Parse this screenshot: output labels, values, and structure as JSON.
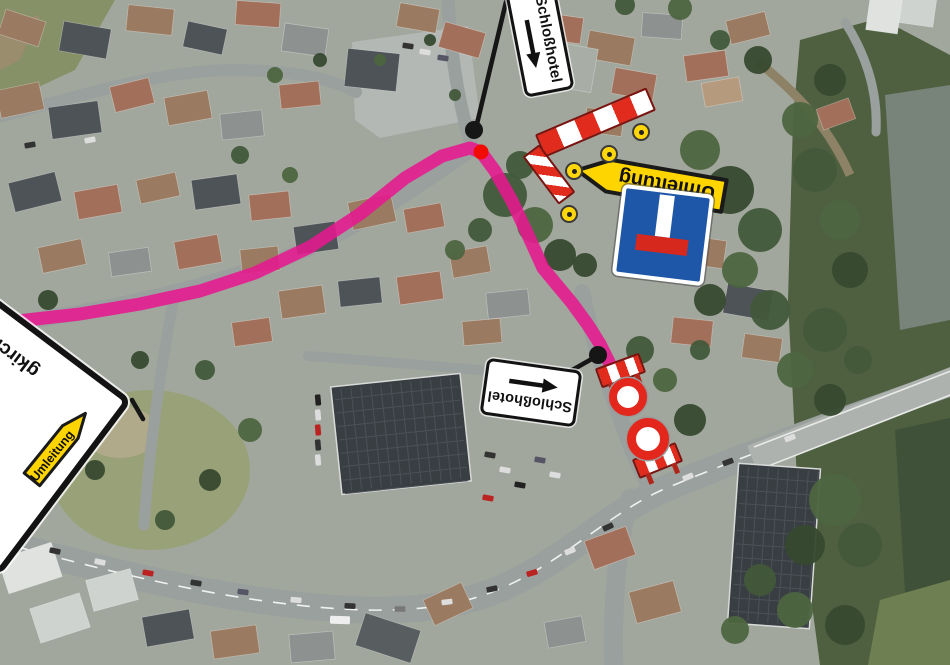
{
  "map": {
    "description": "Aerial town view with marked detour route and road closure",
    "route": {
      "color": "#e6188f",
      "points": [
        [
          18,
          321
        ],
        [
          80,
          314
        ],
        [
          140,
          304
        ],
        [
          200,
          291
        ],
        [
          255,
          273
        ],
        [
          310,
          247
        ],
        [
          360,
          214
        ],
        [
          405,
          178
        ],
        [
          442,
          156
        ],
        [
          470,
          148
        ],
        [
          481,
          152
        ],
        [
          495,
          171
        ],
        [
          512,
          201
        ],
        [
          528,
          235
        ],
        [
          543,
          268
        ],
        [
          557,
          285
        ],
        [
          572,
          303
        ],
        [
          588,
          325
        ],
        [
          600,
          344
        ],
        [
          609,
          362
        ],
        [
          618,
          385
        ],
        [
          626,
          404
        ]
      ],
      "corner_dot": {
        "x": 481,
        "y": 152,
        "r": 7.5,
        "color": "#f10b02"
      },
      "closure_dot": {
        "x": 598,
        "y": 355,
        "r": 9,
        "color": "#161616"
      },
      "pointer_dot": {
        "x": 474,
        "y": 130,
        "r": 9,
        "color": "#161616"
      }
    },
    "poles": [
      {
        "x1": 506,
        "y1": 2,
        "x2": 476,
        "y2": 128
      },
      {
        "x1": 553,
        "y1": 381,
        "x2": 597,
        "y2": 356
      },
      {
        "x1": 132,
        "y1": 400,
        "x2": 143,
        "y2": 419
      }
    ]
  },
  "signs": {
    "schlosshotel_top": {
      "label": "Schloßhotel"
    },
    "schlosshotel_mid": {
      "label": "Schloßhotel"
    },
    "umleitung_large": {
      "label": "Umleitung"
    },
    "umleitung_small": {
      "label": "Umleitung"
    },
    "destination": {
      "partial_text": "gkirche"
    }
  },
  "colors": {
    "detour_yellow": "#ffd500",
    "barrier_red": "#e02b1d",
    "dead_end_blue": "#1e57a8",
    "route_pink": "#e6188f"
  }
}
